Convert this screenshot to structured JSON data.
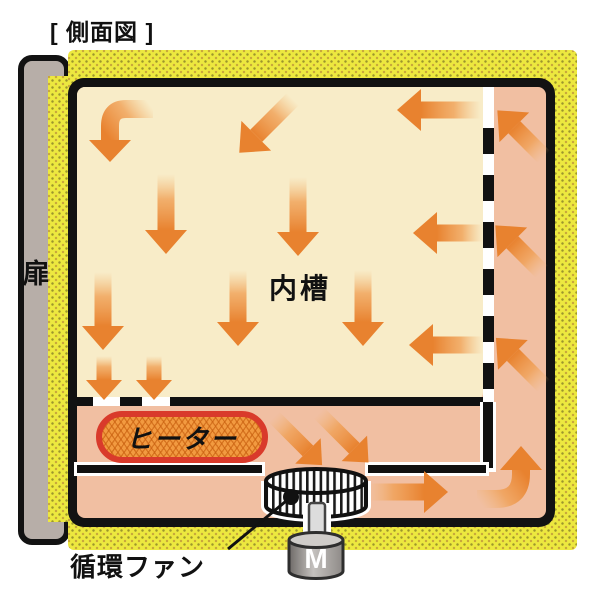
{
  "title": "[ 側面図 ]",
  "labels": {
    "door": "扉",
    "inner_chamber": "内槽",
    "heater": "ヒーター",
    "circulation_fan": "循環ファン",
    "motor": "M"
  },
  "colors": {
    "insulation_yellow": "#EDE83F",
    "insulation_dot": "#9D962C",
    "chamber_cream": "#F8ECC8",
    "duct_salmon": "#F1BFA2",
    "arrow_orange": "#E8822F",
    "heater_fill": "#F29A40",
    "heater_border": "#D93A2B",
    "door_gray": "#B7AEA8",
    "frame_black": "#121212"
  },
  "airflow_arrows": {
    "straight": [
      {
        "dir": "down-left",
        "x": 293,
        "y": 99,
        "len": 52
      },
      {
        "dir": "left",
        "x": 481,
        "y": 110,
        "len": 60
      },
      {
        "dir": "down",
        "x": 166,
        "y": 174,
        "len": 56
      },
      {
        "dir": "down",
        "x": 298,
        "y": 177,
        "len": 55
      },
      {
        "dir": "left",
        "x": 483,
        "y": 233,
        "len": 46
      },
      {
        "dir": "down",
        "x": 103,
        "y": 272,
        "len": 54
      },
      {
        "dir": "down",
        "x": 238,
        "y": 270,
        "len": 52
      },
      {
        "dir": "down",
        "x": 363,
        "y": 270,
        "len": 52
      },
      {
        "dir": "left",
        "x": 483,
        "y": 345,
        "len": 50
      },
      {
        "dir": "down",
        "x": 104,
        "y": 356,
        "len": 24,
        "sw": 15,
        "hl": 20,
        "hw": 36
      },
      {
        "dir": "down",
        "x": 154,
        "y": 356,
        "len": 24,
        "sw": 15,
        "hl": 20,
        "hw": 36
      },
      {
        "dir": "down-right",
        "x": 274,
        "y": 417,
        "len": 48,
        "sw": 15,
        "hl": 20,
        "hw": 36
      },
      {
        "dir": "down-right",
        "x": 319,
        "y": 413,
        "len": 50,
        "sw": 15,
        "hl": 20,
        "hw": 36
      },
      {
        "dir": "right",
        "x": 368,
        "y": 492,
        "len": 56
      },
      {
        "dir": "up-left",
        "x": 544,
        "y": 157,
        "len": 42
      },
      {
        "dir": "up-left",
        "x": 542,
        "y": 272,
        "len": 42
      },
      {
        "dir": "up-left",
        "x": 544,
        "y": 386,
        "len": 44
      }
    ],
    "curved": [
      {
        "name": "elbow-top-left-down",
        "path": "M153 109 L126 109 Q110 109 110 126 L110 140",
        "grad": [
          153,
          109,
          110,
          140
        ],
        "head": {
          "tip": [
            110,
            162
          ],
          "base": 140,
          "hw": 21
        }
      },
      {
        "name": "curve-bottom-right-up",
        "path": "M477 499 L496 499 Q521 499 521 474 L521 470",
        "grad": [
          477,
          499,
          521,
          468
        ],
        "head": {
          "tip": [
            521,
            446
          ],
          "base": 470,
          "hw": 21
        }
      }
    ]
  }
}
